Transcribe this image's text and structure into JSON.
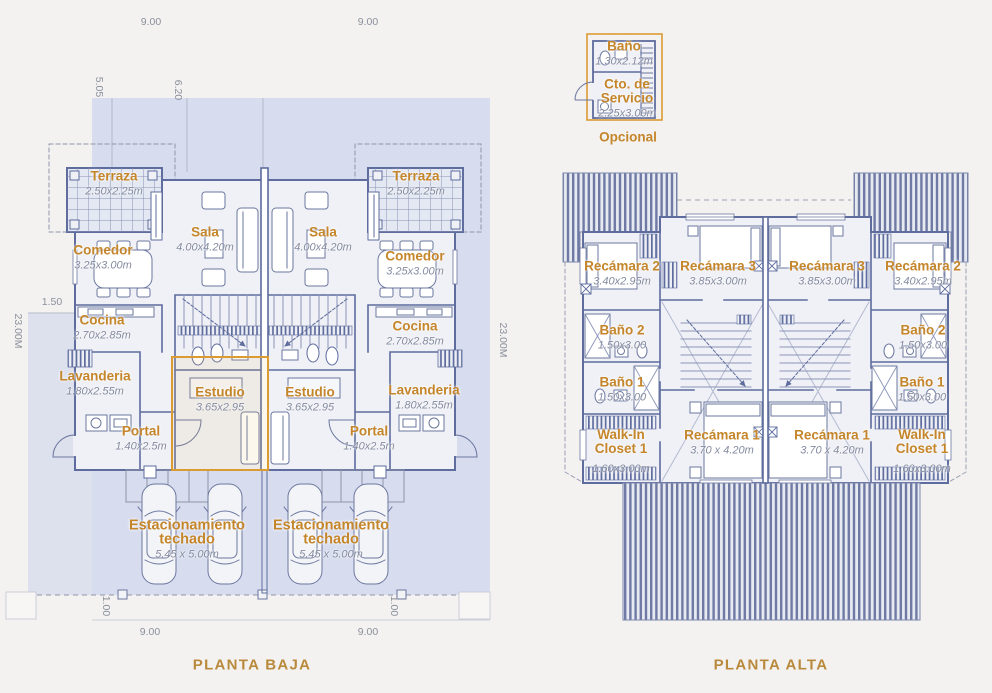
{
  "plan": {
    "planta_baja": {
      "title": "PLANTA BAJA",
      "rooms": [
        {
          "name": "Terraza",
          "dims": "2.50x2.25m"
        },
        {
          "name": "Sala",
          "dims": "4.00x4.20m"
        },
        {
          "name": "Comedor",
          "dims": "3.25x3.00m"
        },
        {
          "name": "Cocina",
          "dims": "2.70x2.85m"
        },
        {
          "name": "Lavanderia",
          "dims": "1.80x2.55m"
        },
        {
          "name": "Estudio",
          "dims": "3.65x2.95"
        },
        {
          "name": "Portal",
          "dims": "1.40x2.5m"
        },
        {
          "name": "Estacionamiento",
          "name2": "techado",
          "dims": "5.45 x 5.00m"
        }
      ],
      "dims": {
        "top_left": "9.00",
        "top_right": "9.00",
        "bottom_left": "9.00",
        "bottom_right": "9.00",
        "side_left": "23.00M",
        "side_right": "23.00M",
        "v1": "5.05",
        "v2": "6.20",
        "setback": "1.50",
        "offset_left": "1.00",
        "offset_right": "1.00"
      }
    },
    "optional": {
      "caption": "Opcional",
      "rooms": [
        {
          "name": "Baño",
          "dims": "1.30x2.12m"
        },
        {
          "name": "Cto. de",
          "name2": "Servicio",
          "dims": "2.25x3.00m"
        }
      ]
    },
    "planta_alta": {
      "title": "PLANTA ALTA",
      "rooms": [
        {
          "name": "Recámara 2",
          "dims": "3.40x2.95m"
        },
        {
          "name": "Recámara 3",
          "dims": "3.85x3.00m"
        },
        {
          "name": "Baño 2",
          "dims": "1.50x3.00"
        },
        {
          "name": "Baño 1",
          "dims": "1.50x3.00"
        },
        {
          "name": "Walk-In",
          "name2": "Closet 1",
          "dims": "1.60x3.00m"
        },
        {
          "name": "Recámara 1",
          "dims": "3.70 x 4.20m"
        }
      ]
    }
  },
  "colors": {
    "background": "#f3f2f0",
    "lot_blue": "#d7dcee",
    "wall_blue": "#5e6c9e",
    "roof_stripe": "#6e7aa4",
    "label_orange": "#c5862b",
    "dims_gray": "#848ba0",
    "title_gold": "#b9893c",
    "highlight_orange": "#db9b33"
  }
}
